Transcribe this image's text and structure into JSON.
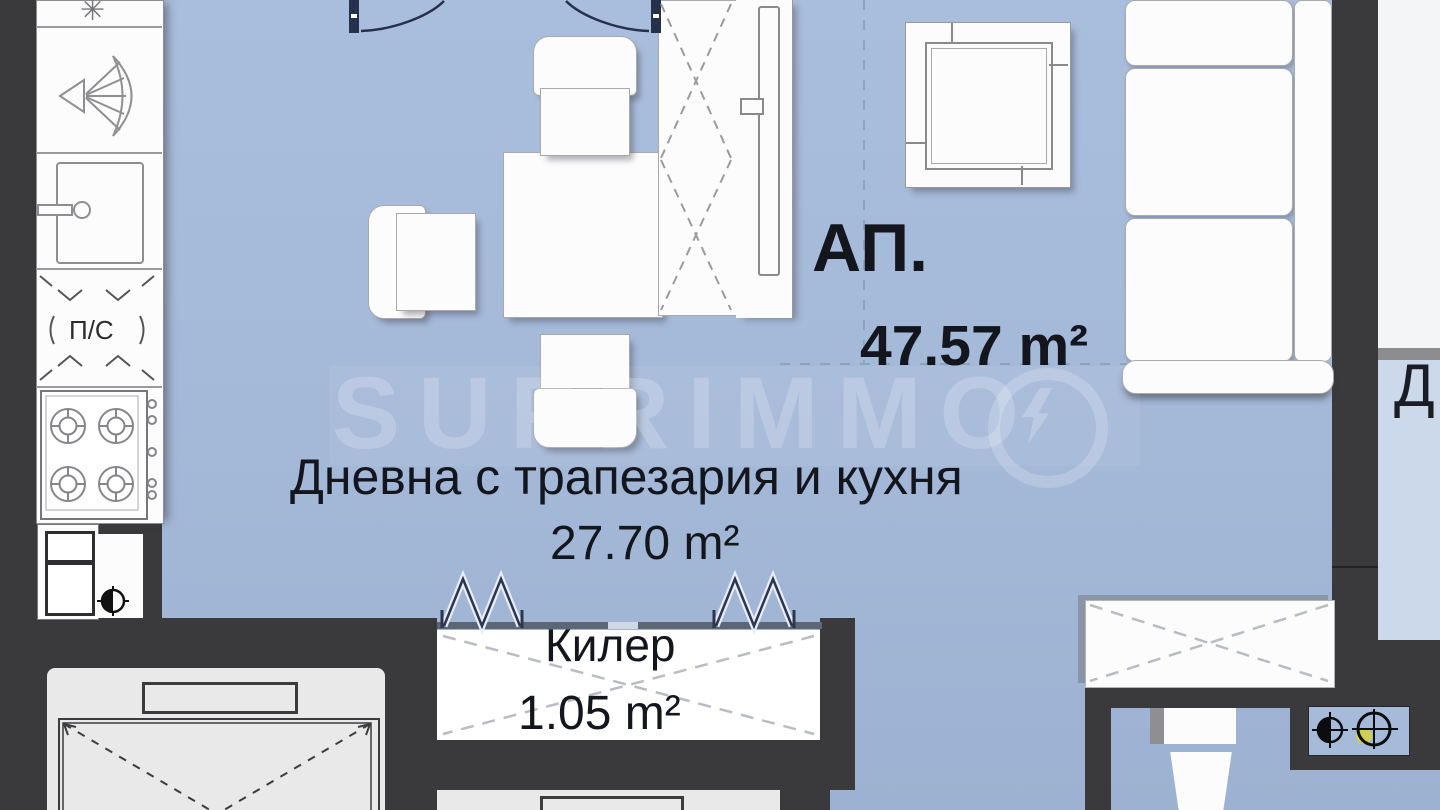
{
  "plan": {
    "apartment": {
      "label": "АП.",
      "area": "47.57 m²"
    },
    "living_room": {
      "label": "Дневна с трапезария и кухня",
      "area": "27.70 m²"
    },
    "closet": {
      "label": "Килер",
      "area": "1.05 m²"
    },
    "kitchen_unit": {
      "label": "П/С"
    },
    "adjacent_room": {
      "label": "Д"
    }
  },
  "icons": {
    "cooktop_glyph": "✳"
  },
  "watermark": {
    "text": "SUPRIMMO"
  },
  "colors": {
    "floor_main": "#a6bad9",
    "floor_adjacent": "#ccd9ea",
    "wall": "#3a3a3c",
    "fixture_white": "#fcfcfd",
    "elevator_gray": "#e9e9ea",
    "door_navy": "#25304d",
    "text": "#14161e",
    "shaft_accent_yellow": "#cfd04b"
  }
}
